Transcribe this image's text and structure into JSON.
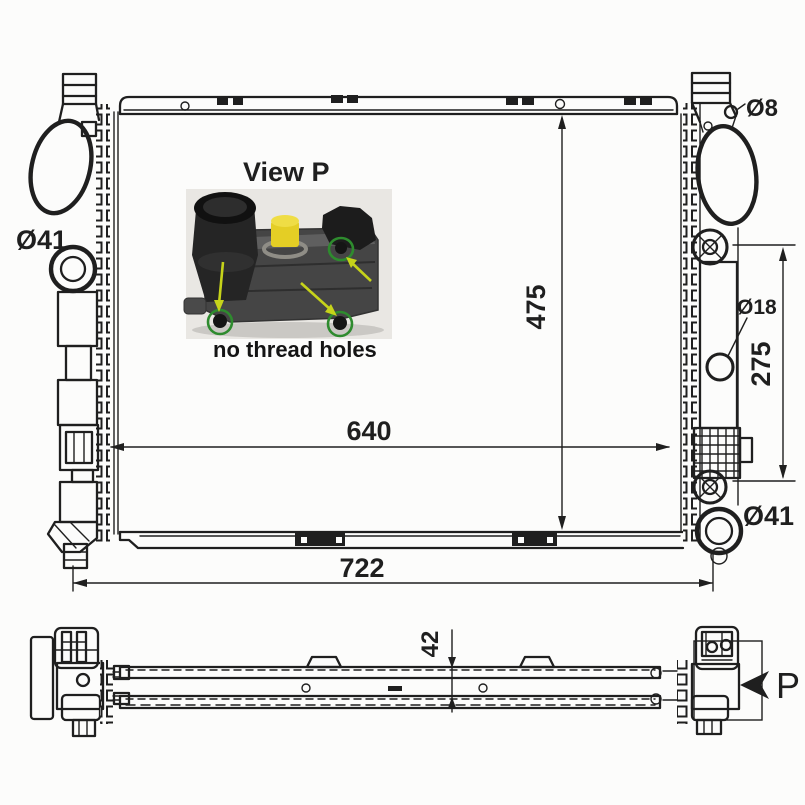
{
  "colors": {
    "ink": "#1f1f1f",
    "paper": "#fcfcfb",
    "cap_yellow": "#e4ce25",
    "cap_yellow_light": "#efdd45",
    "ring_green": "#2e8b2e",
    "arrow_green_yellow": "#c6d31a",
    "photo_body": "#454545",
    "photo_body_light": "#5f5f5f",
    "photo_black": "#1c1c1c"
  },
  "front_view": {
    "dim_core_width": "640",
    "dim_overall_width": "722",
    "dim_core_height": "475",
    "dim_port_spacing": "275",
    "port_top_left": "Ø41",
    "port_bottom_right": "Ø41",
    "hole_top_right": "Ø8",
    "hole_side": "Ø18"
  },
  "inset": {
    "title": "View P",
    "note": "no thread holes"
  },
  "bottom_view": {
    "dim_depth": "42",
    "view_arrow_label": "P"
  }
}
